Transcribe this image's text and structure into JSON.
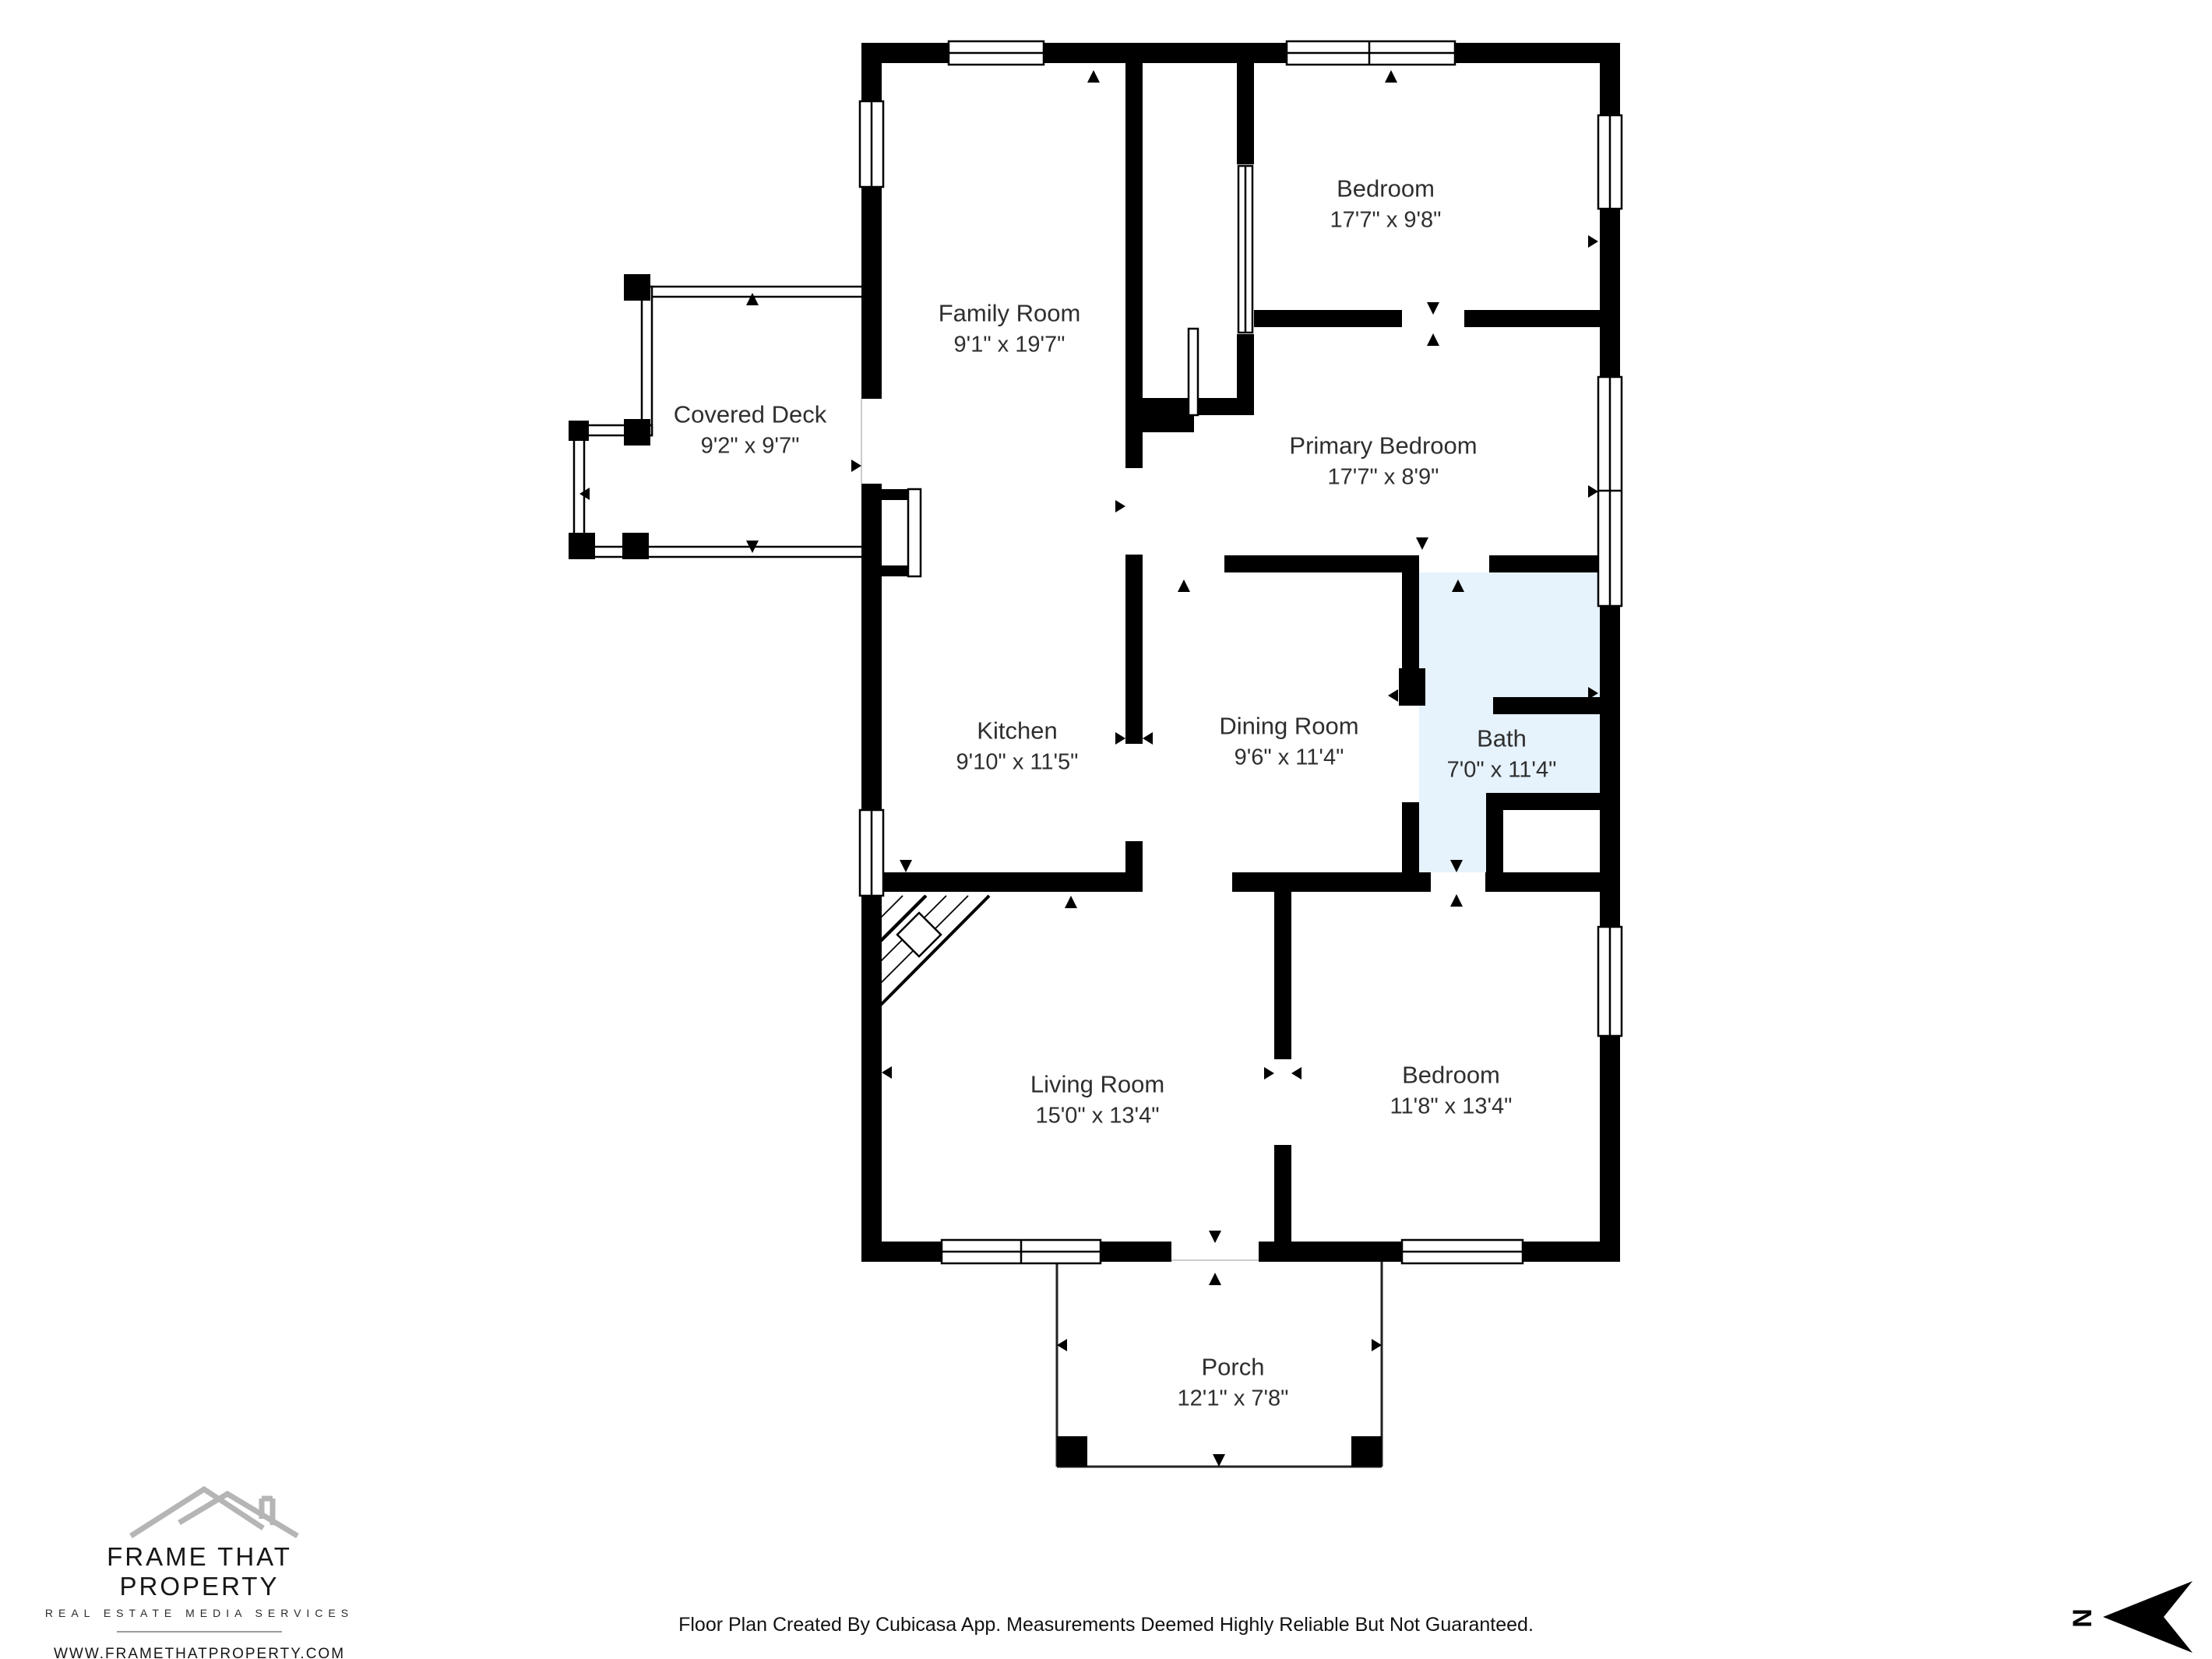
{
  "floorplan": {
    "rooms": [
      {
        "name": "Bedroom",
        "dims": "17'7\" x 9'8\""
      },
      {
        "name": "Family Room",
        "dims": "9'1\" x 19'7\""
      },
      {
        "name": "Covered Deck",
        "dims": "9'2\" x 9'7\""
      },
      {
        "name": "Primary Bedroom",
        "dims": "17'7\" x 8'9\""
      },
      {
        "name": "Kitchen",
        "dims": "9'10\" x 11'5\""
      },
      {
        "name": "Dining Room",
        "dims": "9'6\" x 11'4\""
      },
      {
        "name": "Bath",
        "dims": "7'0\" x 11'4\""
      },
      {
        "name": "Living Room",
        "dims": "15'0\" x 13'4\""
      },
      {
        "name": "Bedroom",
        "dims": "11'8\" x 13'4\""
      },
      {
        "name": "Porch",
        "dims": "12'1\" x 7'8\""
      }
    ],
    "colors": {
      "wall": "#000000",
      "bath_fill": "#E6F2FC",
      "label_text": "#2f2f2f",
      "roof_gray": "#b5b5b5"
    }
  },
  "branding": {
    "company": "FRAME THAT PROPERTY",
    "tagline": "REAL ESTATE MEDIA SERVICES",
    "website": "WWW.FRAMETHATPROPERTY.COM",
    "phone": "910-758-1887"
  },
  "footer": {
    "disclaimer": "Floor Plan Created By Cubicasa App. Measurements Deemed Highly Reliable But Not Guaranteed."
  },
  "compass": {
    "direction": "N"
  }
}
